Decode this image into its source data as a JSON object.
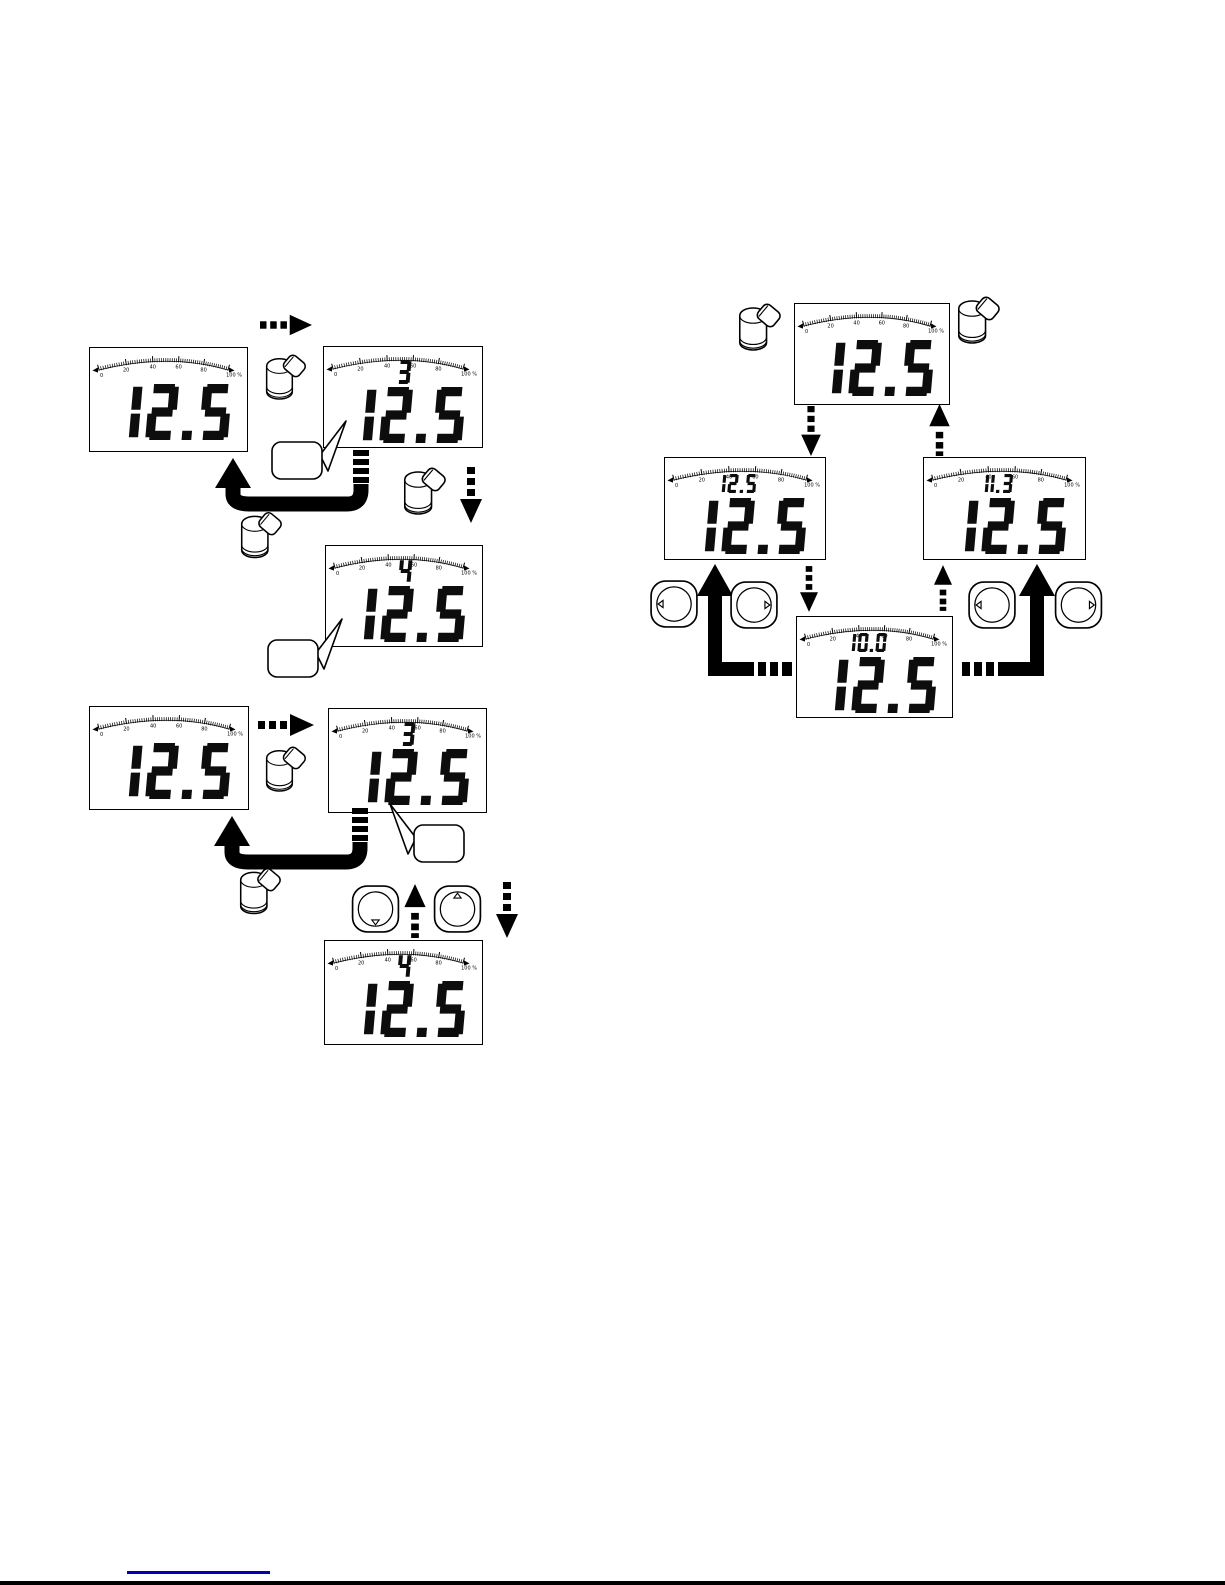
{
  "page": {
    "background_color": "#ffffff",
    "bottom_rule_color": "#000000",
    "footer_link_underline_color": "#0000bb"
  },
  "lcd_scale": {
    "tick_labels": [
      "0",
      "20",
      "40",
      "60",
      "80"
    ],
    "end_label": "100 %"
  },
  "figure_top_left": {
    "lcd_normal": {
      "small_value": "",
      "big_value": "12.5"
    },
    "lcd_setting_3": {
      "small_value": "3",
      "big_value": "12.5"
    },
    "lcd_setting_4": {
      "small_value": "4",
      "big_value": "12.5"
    }
  },
  "figure_bottom_left": {
    "lcd_normal": {
      "small_value": "",
      "big_value": "12.5"
    },
    "lcd_setting_3": {
      "small_value": "3",
      "big_value": "12.5"
    },
    "lcd_setting_4": {
      "small_value": "4",
      "big_value": "12.5"
    }
  },
  "figure_right": {
    "lcd_top": {
      "small_value": "",
      "big_value": "12.5"
    },
    "lcd_left": {
      "small_value": "12.5",
      "big_value": "12.5"
    },
    "lcd_right": {
      "small_value": "11.3",
      "big_value": "12.5"
    },
    "lcd_bottom": {
      "small_value": "10.0",
      "big_value": "12.5"
    }
  },
  "icons": {
    "magnet_pen": "magnet-pen",
    "button_triangle_left": "◁",
    "button_triangle_right": "▷",
    "button_triangle_up": "△",
    "button_triangle_down": "▽"
  }
}
